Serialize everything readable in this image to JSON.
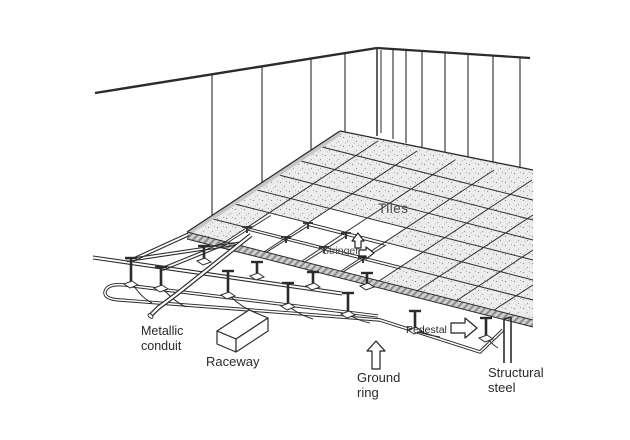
{
  "diagram": {
    "type": "raised-floor-cutaway-illustration",
    "labels": {
      "tiles": "Tiles",
      "stringer": "Stringer",
      "pedestal": "Pedestal",
      "metallic_conduit_line1": "Metallic",
      "metallic_conduit_line2": "conduit",
      "raceway": "Raceway",
      "ground_ring_line1": "Ground",
      "ground_ring_line2": "ring",
      "structural_steel_line1": "Structural",
      "structural_steel_line2": "steel"
    },
    "icons": [
      "stringer-up-arrow-icon",
      "stringer-right-arrow-icon",
      "pedestal-right-arrow-icon",
      "ground-ring-up-arrow-icon"
    ],
    "colors": {
      "background": "#ffffff",
      "line": "#2b2b2b",
      "label_gray": "#4a4a4a",
      "label_dark": "#2a2a2a",
      "tile_fill": "#ececec",
      "stipple_dot": "#8f8f8f",
      "edge_band": "#c6c6c6",
      "band_hatch": "#8a8a8a"
    }
  }
}
